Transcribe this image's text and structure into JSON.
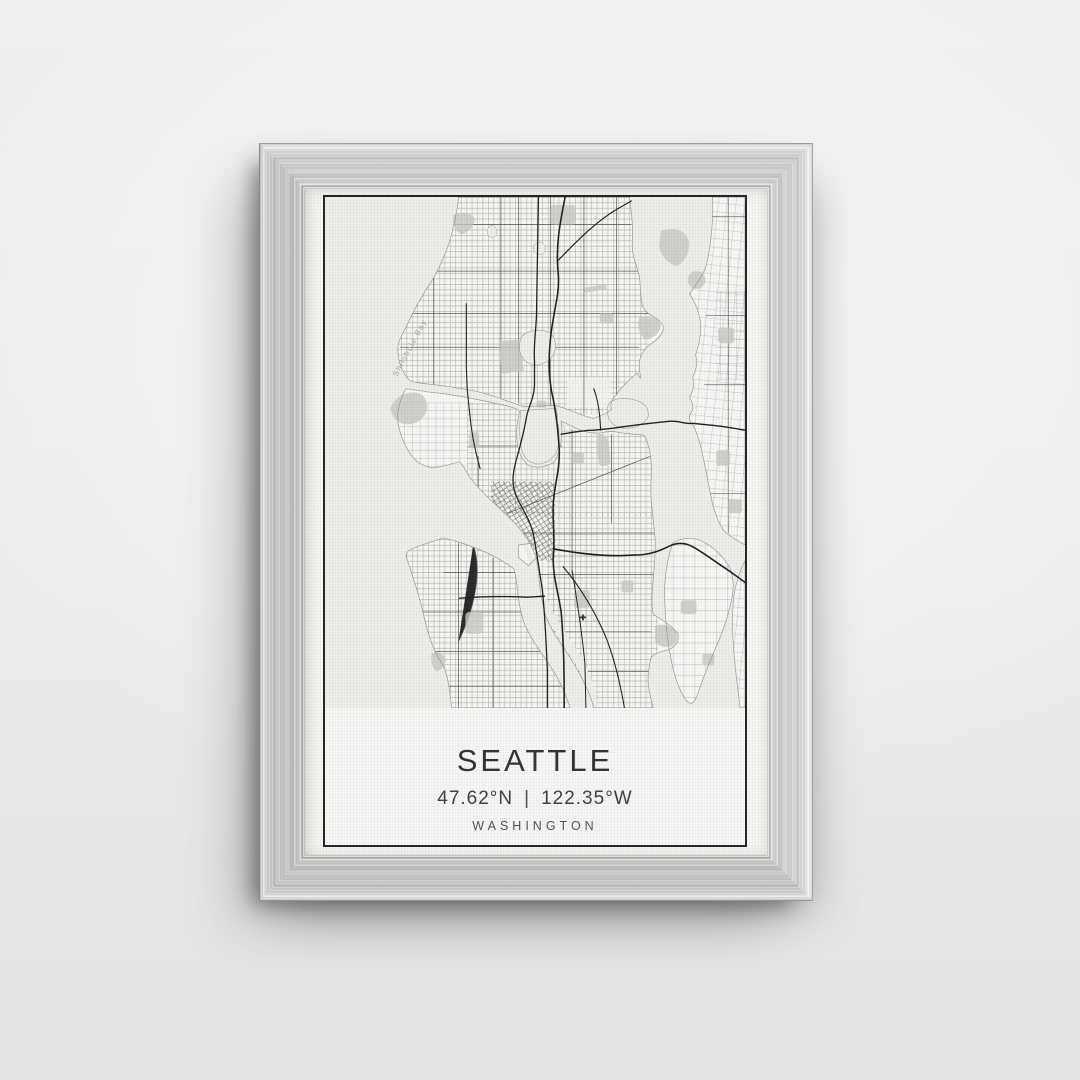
{
  "poster": {
    "city": "SEATTLE",
    "latitude": "47.62°N",
    "coord_separator": "|",
    "longitude": "122.35°W",
    "region": "WASHINGTON"
  },
  "map": {
    "labels": {
      "bay": "Shilshole Bay"
    }
  },
  "colors": {
    "wall": "#eaeaea",
    "frame_silver": "#d4d4d2",
    "canvas_white": "#f7f6f4",
    "print_border": "#1f1f1f",
    "map_water": "#ededeb",
    "map_land": "#f9f8f6",
    "map_park": "#c7c7c4",
    "map_highway": "#1a1a1a",
    "map_label_gray": "#a3a3a1",
    "title_text": "#2d2d2d"
  }
}
